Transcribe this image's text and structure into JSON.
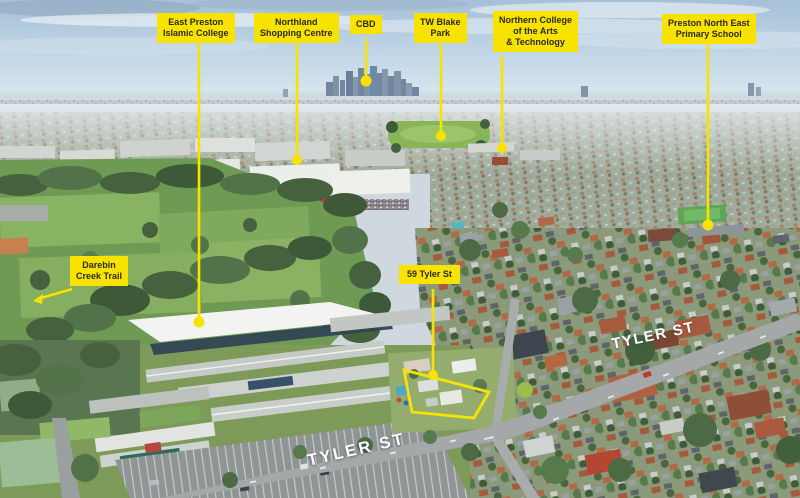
{
  "annotations": {
    "east_preston_islamic_college": {
      "label": "East Preston\nIslamic College"
    },
    "northland_shopping_centre": {
      "label": "Northland\nShopping Centre"
    },
    "cbd": {
      "label": "CBD"
    },
    "tw_blake_park": {
      "label": "TW Blake\nPark"
    },
    "northern_college": {
      "label": "Northern College\nof the Arts\n& Technology"
    },
    "preston_north_east_primary": {
      "label": "Preston North East\nPrimary School"
    },
    "darebin_creek_trail": {
      "label": "Darebin\nCreek Trail"
    },
    "subject_property": {
      "label": "59 Tyler St"
    }
  },
  "street_labels": {
    "tyler_st_mid": "TYLER ST",
    "tyler_st_bottom": "TYLER ST"
  },
  "colors": {
    "annotation_yellow": "#F8E300",
    "label_text": "#2A2A20",
    "street_text": "#FFFFFF"
  }
}
